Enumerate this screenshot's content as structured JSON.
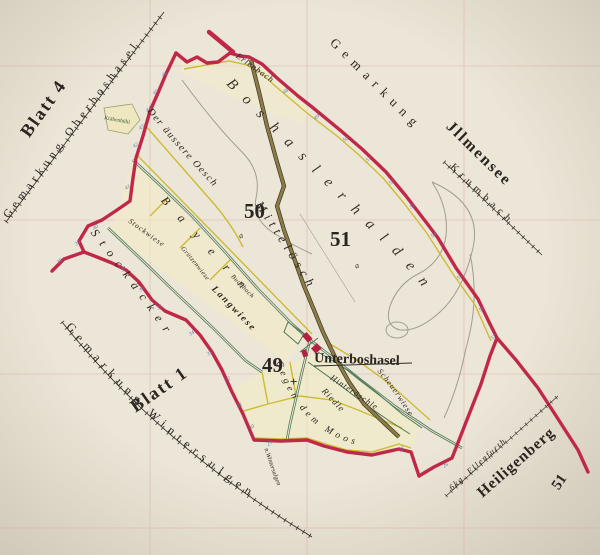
{
  "map": {
    "sheet_labels": {
      "blatt4": "Blatt 4",
      "blatt1": "Blatt 1",
      "neighbor_sheet_51": "51"
    },
    "gemarkungen": {
      "oberboshasel": "Gemarkung Oberboshasel",
      "wintersulgen": "Gemarkung Wintersulgen",
      "illmensee_prefix": "Gemarkung",
      "illmensee": "Jllmensee",
      "krumbach": "Krumbach",
      "heiligenberg": "Heiligenberg",
      "ellenfurth": "6kg. Ellenfurth"
    },
    "settlement": {
      "name": "Unterboshasel"
    },
    "sections": {
      "s49": "49",
      "s49_mark": "+",
      "s50": "50",
      "s50_mark": "a",
      "s51": "51",
      "s51_mark": "a"
    },
    "gewanne": {
      "boshaslerhalden": "Boshaslerhalden",
      "mitteloesch": "Mittelösch",
      "stockaecker": "Stockäcker",
      "bayern": "Bayern",
      "gegen_dem_moos": "Gegen dem Moos",
      "der_aeussere_oesch": "Der äussere Oesch",
      "stockwiese": "Stockwiese",
      "gruetzenwiese": "Grützenwiese",
      "langwiese": "Langwiese",
      "buchbach": "Buchbach",
      "riedle": "Riedle",
      "hinteroeschle": "Hinteröschle",
      "scheuerwiese": "Scheuerwiese",
      "kraehenbuehl": "Krähenbühl",
      "erlenbach": "Erlenbach",
      "n_wintersulgen": "n.Wintersulgen"
    },
    "colors": {
      "boundary_red": "#c02848",
      "parcel_yellow": "#cdbb35",
      "road_green": "#4d7854",
      "road_olive": "#8d7b44",
      "stone_blue": "#6679a8",
      "grid_pink": "#d9a5a3",
      "paper": "#ece6d8"
    },
    "stones": [
      {
        "n": "46",
        "x": 163,
        "y": 77
      },
      {
        "n": "45",
        "x": 154,
        "y": 95
      },
      {
        "n": "44",
        "x": 147,
        "y": 112
      },
      {
        "n": "43",
        "x": 140,
        "y": 130
      },
      {
        "n": "42",
        "x": 134,
        "y": 148
      },
      {
        "n": "41",
        "x": 126,
        "y": 190
      },
      {
        "n": "40",
        "x": 94,
        "y": 230
      },
      {
        "n": "39",
        "x": 76,
        "y": 246
      },
      {
        "n": "38",
        "x": 58,
        "y": 264
      },
      {
        "n": "37",
        "x": 122,
        "y": 272
      },
      {
        "n": "36",
        "x": 140,
        "y": 292
      },
      {
        "n": "35",
        "x": 158,
        "y": 310
      },
      {
        "n": "34",
        "x": 190,
        "y": 336
      },
      {
        "n": "33",
        "x": 208,
        "y": 356
      },
      {
        "n": "32",
        "x": 226,
        "y": 382
      },
      {
        "n": "31",
        "x": 238,
        "y": 408
      },
      {
        "n": "30",
        "x": 250,
        "y": 430
      },
      {
        "n": "29",
        "x": 268,
        "y": 446
      },
      {
        "n": "48",
        "x": 284,
        "y": 94
      },
      {
        "n": "49",
        "x": 315,
        "y": 120
      },
      {
        "n": "50",
        "x": 344,
        "y": 142
      },
      {
        "n": "51",
        "x": 367,
        "y": 162
      },
      {
        "n": "52",
        "x": 390,
        "y": 185
      },
      {
        "n": "53",
        "x": 411,
        "y": 209
      },
      {
        "n": "54",
        "x": 432,
        "y": 238
      },
      {
        "n": "55",
        "x": 458,
        "y": 280
      },
      {
        "n": "56",
        "x": 480,
        "y": 312
      },
      {
        "n": "57",
        "x": 492,
        "y": 340
      },
      {
        "n": "26",
        "x": 444,
        "y": 468
      },
      {
        "n": "27",
        "x": 400,
        "y": 452
      }
    ]
  }
}
